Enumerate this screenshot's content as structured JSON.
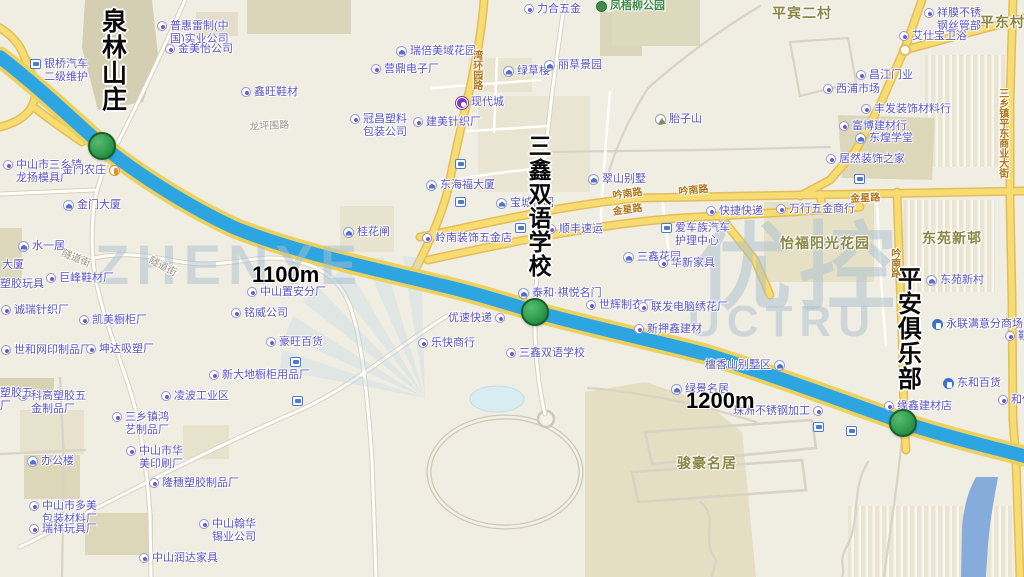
{
  "map": {
    "big_labels": [
      {
        "x": 97,
        "y": 8,
        "t": "泉林山庄",
        "fs": 25
      },
      {
        "x": 524,
        "y": 134,
        "t": "三鑫双语学校",
        "fs": 23
      },
      {
        "x": 892,
        "y": 266,
        "t": "平安俱乐部",
        "fs": 24
      }
    ],
    "distance_labels": [
      {
        "x": 252,
        "y": 262,
        "t": "1100m"
      },
      {
        "x": 686,
        "y": 388,
        "t": "1200m"
      }
    ],
    "markers": [
      {
        "x": 102,
        "y": 146
      },
      {
        "x": 535,
        "y": 312
      },
      {
        "x": 903,
        "y": 423
      }
    ],
    "watermarks": [
      {
        "x": 95,
        "y": 232,
        "t": "ZHENYE",
        "fs": 56
      },
      {
        "x": 688,
        "y": 296,
        "t": "UCTRU",
        "fs": 44
      },
      {
        "x": 696,
        "y": 212,
        "t": "优控",
        "fs": 96
      }
    ],
    "labels": [
      {
        "x": 30,
        "y": 58,
        "t": "银桥汽车\n二级维护",
        "i": "bus"
      },
      {
        "x": 157,
        "y": 20,
        "t": "普惠雷制(中\n国)实业公司",
        "i": "dot"
      },
      {
        "x": 165,
        "y": 43,
        "t": "金美怡公司",
        "i": "dot"
      },
      {
        "x": 241,
        "y": 86,
        "t": "鑫旺鞋材",
        "i": "dot"
      },
      {
        "x": 249,
        "y": 122,
        "t": "龙坪围路",
        "c": "roadg",
        "r": -3
      },
      {
        "x": 3,
        "y": 159,
        "t": "中山市三乡镇\n龙扬模具厂",
        "i": "dot"
      },
      {
        "x": 62,
        "y": 164,
        "t": "金门农庄",
        "i": "food",
        "ir": 1
      },
      {
        "x": 63,
        "y": 199,
        "t": "金门大厦",
        "i": "bldg"
      },
      {
        "x": 18,
        "y": 240,
        "t": "水一居",
        "i": "bldg"
      },
      {
        "x": -12,
        "y": 259,
        "t": "大厦",
        "i": "bldg"
      },
      {
        "x": 0,
        "y": 278,
        "t": "塑胶玩具"
      },
      {
        "x": 46,
        "y": 272,
        "t": "巨峰鞋材厂",
        "i": "dot"
      },
      {
        "x": 1,
        "y": 304,
        "t": "诚瑞针织厂",
        "i": "dot"
      },
      {
        "x": 79,
        "y": 314,
        "t": "凯美橱柜厂",
        "i": "dot"
      },
      {
        "x": 1,
        "y": 344,
        "t": "世和网印制品厂",
        "i": "dot"
      },
      {
        "x": 86,
        "y": 343,
        "t": "坤达吸塑厂",
        "i": "dot"
      },
      {
        "x": 247,
        "y": 286,
        "t": "中山置安分厂",
        "i": "dot"
      },
      {
        "x": 231,
        "y": 307,
        "t": "铭威公司",
        "i": "dot"
      },
      {
        "x": 266,
        "y": 336,
        "t": "豪旺百货",
        "i": "dot"
      },
      {
        "x": 209,
        "y": 369,
        "t": "新大地橱柜用品厂",
        "i": "dot"
      },
      {
        "x": 343,
        "y": 226,
        "t": "桂花闸",
        "i": "bldg"
      },
      {
        "x": 524,
        "y": 3,
        "t": "力合五金",
        "i": "dot"
      },
      {
        "x": 396,
        "y": 45,
        "t": "瑞倍美域花园",
        "i": "bldg"
      },
      {
        "x": 371,
        "y": 63,
        "t": "营鼎电子厂",
        "i": "dot"
      },
      {
        "x": 503,
        "y": 65,
        "t": "绿草楼",
        "i": "bldg"
      },
      {
        "x": 544,
        "y": 59,
        "t": "丽草景园",
        "i": "bldg"
      },
      {
        "x": 456,
        "y": 96,
        "t": "现代城",
        "i": "metro"
      },
      {
        "x": 350,
        "y": 113,
        "t": "冠昌塑料\n包装公司",
        "i": "dot"
      },
      {
        "x": 413,
        "y": 116,
        "t": "建美针织厂",
        "i": "dot"
      },
      {
        "x": 655,
        "y": 113,
        "t": "胎子山",
        "i": "mount"
      },
      {
        "x": 588,
        "y": 173,
        "t": "翠山别墅",
        "i": "bldg"
      },
      {
        "x": 426,
        "y": 179,
        "t": "东海福大厦",
        "i": "bldg"
      },
      {
        "x": 496,
        "y": 197,
        "t": "宝城花园",
        "i": "bldg"
      },
      {
        "x": 422,
        "y": 232,
        "t": "岭南装饰五金店",
        "i": "dot"
      },
      {
        "x": 546,
        "y": 223,
        "t": "顺丰速运",
        "i": "dot"
      },
      {
        "x": 623,
        "y": 251,
        "t": "三鑫花园",
        "i": "bldg"
      },
      {
        "x": 658,
        "y": 257,
        "t": "华新家具",
        "i": "dot"
      },
      {
        "x": 518,
        "y": 287,
        "t": "泰和·祺悦名门",
        "i": "bldg"
      },
      {
        "x": 586,
        "y": 299,
        "t": "世辉制衣厂",
        "i": "dot"
      },
      {
        "x": 638,
        "y": 301,
        "t": "联发电脑绣花厂",
        "i": "dot"
      },
      {
        "x": 634,
        "y": 323,
        "t": "新押鑫建材",
        "i": "dot"
      },
      {
        "x": 448,
        "y": 312,
        "t": "优速快递",
        "i": "dot",
        "ir": 1
      },
      {
        "x": 418,
        "y": 337,
        "t": "乐快商行",
        "i": "dot"
      },
      {
        "x": 506,
        "y": 347,
        "t": "三鑫双语学校",
        "i": "dot"
      },
      {
        "x": 705,
        "y": 359,
        "t": "檀香山别墅区",
        "i": "bldg",
        "ir": 1
      },
      {
        "x": 671,
        "y": 383,
        "t": "绿景名居",
        "i": "bldg"
      },
      {
        "x": 733,
        "y": 405,
        "t": "珠洲不锈钢加工",
        "i": "dot",
        "ir": 1
      },
      {
        "x": 884,
        "y": 400,
        "t": "缘鑫建材店",
        "i": "dot"
      },
      {
        "x": 943,
        "y": 377,
        "t": "东和百货",
        "i": "shop"
      },
      {
        "x": 998,
        "y": 394,
        "t": "和信",
        "i": "dot"
      },
      {
        "x": 1005,
        "y": 330,
        "t": "鞋材",
        "i": "dot"
      },
      {
        "x": 677,
        "y": 455,
        "t": "骏豪名居",
        "c": "area"
      },
      {
        "x": 926,
        "y": 274,
        "t": "东苑新村",
        "i": "bldg"
      },
      {
        "x": 932,
        "y": 318,
        "t": "永联满意分商场",
        "i": "shop"
      },
      {
        "x": 706,
        "y": 205,
        "t": "快捷快递",
        "i": "dot"
      },
      {
        "x": 776,
        "y": 203,
        "t": "万行五金商行",
        "i": "dot"
      },
      {
        "x": 661,
        "y": 222,
        "t": "爱车族汽车\n护理中心",
        "i": "bus"
      },
      {
        "x": 780,
        "y": 235,
        "t": "怡福阳光花园",
        "c": "area"
      },
      {
        "x": 922,
        "y": 230,
        "t": "东苑新邨",
        "c": "area"
      },
      {
        "x": 772,
        "y": 5,
        "t": "平宾二村",
        "c": "area"
      },
      {
        "x": 980,
        "y": 14,
        "t": "平东村",
        "c": "area"
      },
      {
        "x": 924,
        "y": 7,
        "t": "祥膜不锈\n钢丝管部",
        "i": "dot"
      },
      {
        "x": 899,
        "y": 30,
        "t": "艾仕宝卫浴",
        "i": "dot"
      },
      {
        "x": 856,
        "y": 69,
        "t": "昌江门业",
        "i": "dot"
      },
      {
        "x": 823,
        "y": 83,
        "t": "西浦市场",
        "i": "dot"
      },
      {
        "x": 861,
        "y": 103,
        "t": "丰发装饰材料行",
        "i": "dot"
      },
      {
        "x": 839,
        "y": 120,
        "t": "富博建材行",
        "i": "dot"
      },
      {
        "x": 855,
        "y": 132,
        "t": "东煌学堂",
        "i": "bldg"
      },
      {
        "x": 826,
        "y": 153,
        "t": "居然装饰之家",
        "i": "dot"
      },
      {
        "x": 996,
        "y": 88,
        "t": "三乡镇平东商业大街",
        "c": "roado",
        "v": 1
      },
      {
        "x": 612,
        "y": 191,
        "t": "吟南路",
        "c": "roado",
        "r": -8
      },
      {
        "x": 678,
        "y": 187,
        "t": "吟南路",
        "c": "roado",
        "r": -6
      },
      {
        "x": 612,
        "y": 207,
        "t": "金星路",
        "c": "roado",
        "r": -8
      },
      {
        "x": 850,
        "y": 194,
        "t": "金星路",
        "c": "roado",
        "r": -3
      },
      {
        "x": 888,
        "y": 248,
        "t": "吟南路",
        "c": "roado",
        "v": 1
      },
      {
        "x": 470,
        "y": 50,
        "t": "湾环园路",
        "c": "roado",
        "v": 1
      },
      {
        "x": 64,
        "y": 248,
        "t": "隧道街",
        "c": "roadg",
        "r": 22
      },
      {
        "x": 152,
        "y": 255,
        "t": "隧道街",
        "c": "roadg",
        "r": 28
      },
      {
        "x": 596,
        "y": 0,
        "t": "凤梧柳公园",
        "c": "park",
        "i": "tree"
      },
      {
        "x": 27,
        "y": 455,
        "t": "办公楼",
        "i": "bldg"
      },
      {
        "x": 18,
        "y": 390,
        "t": "科高塑胶五\n金制品厂",
        "i": "dot"
      },
      {
        "x": 0,
        "y": 387,
        "t": "塑胶五\n厂"
      },
      {
        "x": 112,
        "y": 411,
        "t": "三乡镇鸿\n艺制品厂",
        "i": "dot"
      },
      {
        "x": 161,
        "y": 390,
        "t": "凌波工业区",
        "i": "dot"
      },
      {
        "x": 126,
        "y": 445,
        "t": "中山市华\n美印刷厂",
        "i": "dot"
      },
      {
        "x": 149,
        "y": 477,
        "t": "隆穗塑胶制品厂",
        "i": "dot"
      },
      {
        "x": 29,
        "y": 500,
        "t": "中山市多美\n包装材料厂",
        "i": "dot"
      },
      {
        "x": 29,
        "y": 523,
        "t": "瑞祥玩具厂",
        "i": "dot"
      },
      {
        "x": 199,
        "y": 518,
        "t": "中山翰华\n锡业公司",
        "i": "dot"
      },
      {
        "x": 139,
        "y": 552,
        "t": "中山润达家具",
        "i": "dot"
      },
      {
        "x": 452,
        "y": 158,
        "t": "",
        "i": "bus"
      },
      {
        "x": 452,
        "y": 196,
        "t": "",
        "i": "bus"
      },
      {
        "x": 512,
        "y": 222,
        "t": "",
        "i": "bus"
      },
      {
        "x": 287,
        "y": 356,
        "t": "",
        "i": "bus"
      },
      {
        "x": 289,
        "y": 395,
        "t": "",
        "i": "bus"
      },
      {
        "x": 810,
        "y": 421,
        "t": "",
        "i": "bus"
      },
      {
        "x": 843,
        "y": 425,
        "t": "",
        "i": "bus"
      },
      {
        "x": 851,
        "y": 173,
        "t": "",
        "i": "bus"
      }
    ]
  }
}
